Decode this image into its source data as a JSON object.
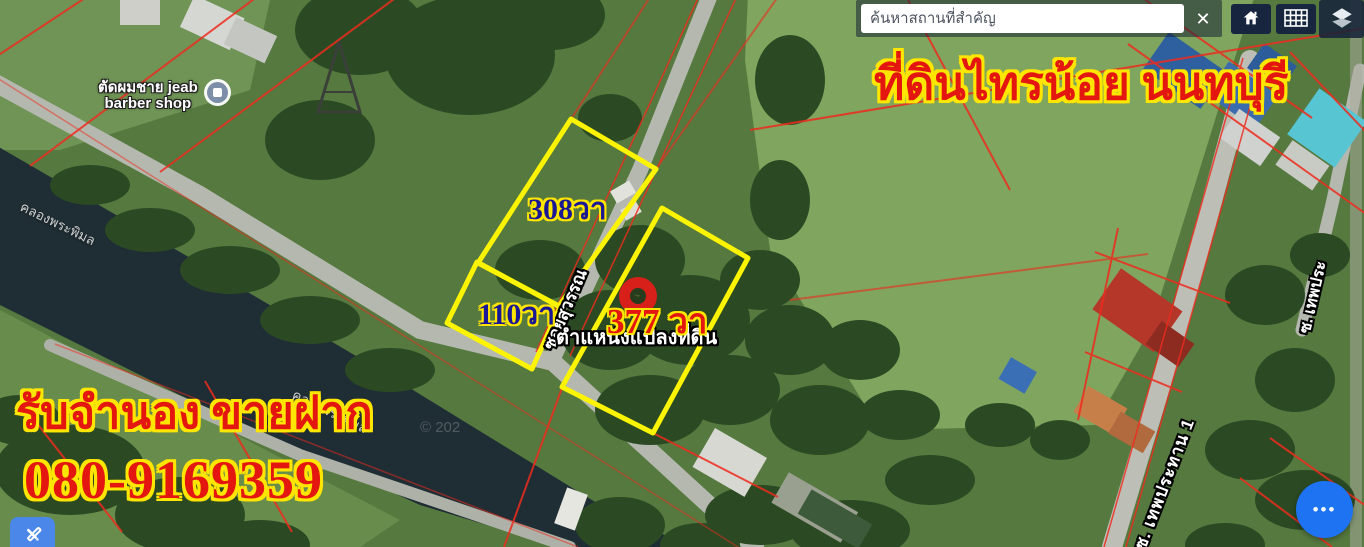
{
  "search": {
    "placeholder": "ค้นหาสถานที่สำคัญ",
    "clear_icon": "✕"
  },
  "map_controls": {
    "icons": [
      "home-icon",
      "basemap-grid-icon",
      "layers-icon"
    ]
  },
  "overlay": {
    "title": "ที่ดินไทรน้อย นนทบุรี",
    "promo_line": "รับจำนอง ขายฝาก",
    "phone": "080-9169359"
  },
  "plots": [
    {
      "label": "308วา"
    },
    {
      "label": "110วา"
    },
    {
      "label": "377 วา"
    }
  ],
  "marker": {
    "caption": "ตำแหน่งแปลงที่ดิน",
    "icon": "location-pin"
  },
  "pois": {
    "barber": {
      "line1": "ตัดผมชาย jeab",
      "line2": "barber shop"
    }
  },
  "waterways": {
    "canal_name": "คลองพระพิมล"
  },
  "roads": {
    "soi_suwan": "ซอยสุวรรณ",
    "soi_thep_prathan": "ซ. เทพประทาน 1",
    "soi_right_edge": "ซ. เทพประ"
  },
  "watermark": "© 202",
  "fab": {
    "more_icon": "•••"
  },
  "colors": {
    "plot_outline_yellow": "#fdf403",
    "cadastral_red": "#ee2c1e",
    "ad_text_red": "#e41610",
    "ad_outline_yellow": "#ffe600",
    "area_label_navy": "#1a1894",
    "accent_blue": "#1d73f2",
    "water_dark": "#1f2d34"
  }
}
